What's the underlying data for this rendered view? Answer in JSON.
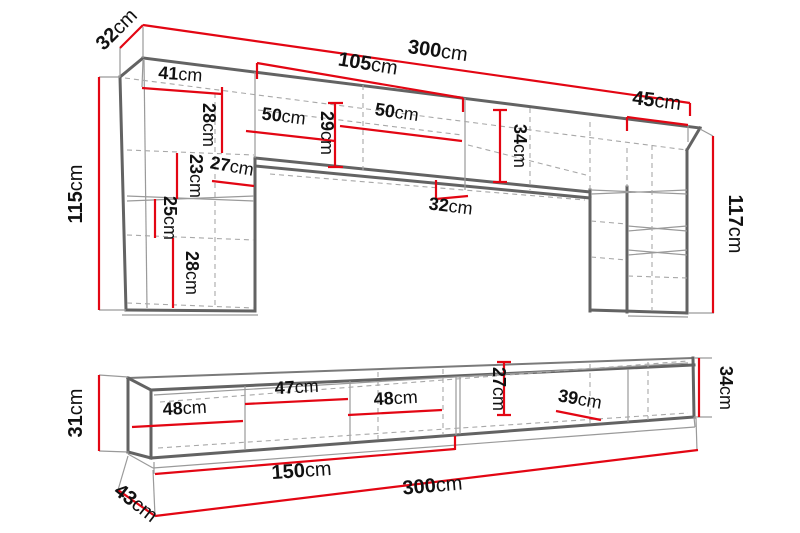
{
  "meta": {
    "type": "furniture-dimension-diagram",
    "unit": "cm",
    "colors": {
      "dimension_line": "#e30613",
      "structure": "#636363",
      "text": "#111111",
      "background": "#ffffff"
    }
  },
  "top": {
    "d32tl": {
      "v": "32",
      "u": "cm"
    },
    "d300": {
      "v": "300",
      "u": "cm"
    },
    "d105": {
      "v": "105",
      "u": "cm"
    },
    "d41": {
      "v": "41",
      "u": "cm"
    },
    "d45": {
      "v": "45",
      "u": "cm"
    },
    "d28a": {
      "v": "28",
      "u": "cm"
    },
    "d23": {
      "v": "23",
      "u": "cm"
    },
    "d25": {
      "v": "25",
      "u": "cm"
    },
    "d28b": {
      "v": "28",
      "u": "cm"
    },
    "d115": {
      "v": "115",
      "u": "cm"
    },
    "d117": {
      "v": "117",
      "u": "cm"
    },
    "d50a": {
      "v": "50",
      "u": "cm"
    },
    "d50b": {
      "v": "50",
      "u": "cm"
    },
    "d29": {
      "v": "29",
      "u": "cm"
    },
    "d34": {
      "v": "34",
      "u": "cm"
    },
    "d27": {
      "v": "27",
      "u": "cm"
    },
    "d32mid": {
      "v": "32",
      "u": "cm"
    }
  },
  "bottom": {
    "d31": {
      "v": "31",
      "u": "cm"
    },
    "d48a": {
      "v": "48",
      "u": "cm"
    },
    "d47": {
      "v": "47",
      "u": "cm"
    },
    "d48b": {
      "v": "48",
      "u": "cm"
    },
    "d27": {
      "v": "27",
      "u": "cm"
    },
    "d39": {
      "v": "39",
      "u": "cm"
    },
    "d34": {
      "v": "34",
      "u": "cm"
    },
    "d150": {
      "v": "150",
      "u": "cm"
    },
    "d300": {
      "v": "300",
      "u": "cm"
    },
    "d43": {
      "v": "43",
      "u": "cm"
    }
  }
}
